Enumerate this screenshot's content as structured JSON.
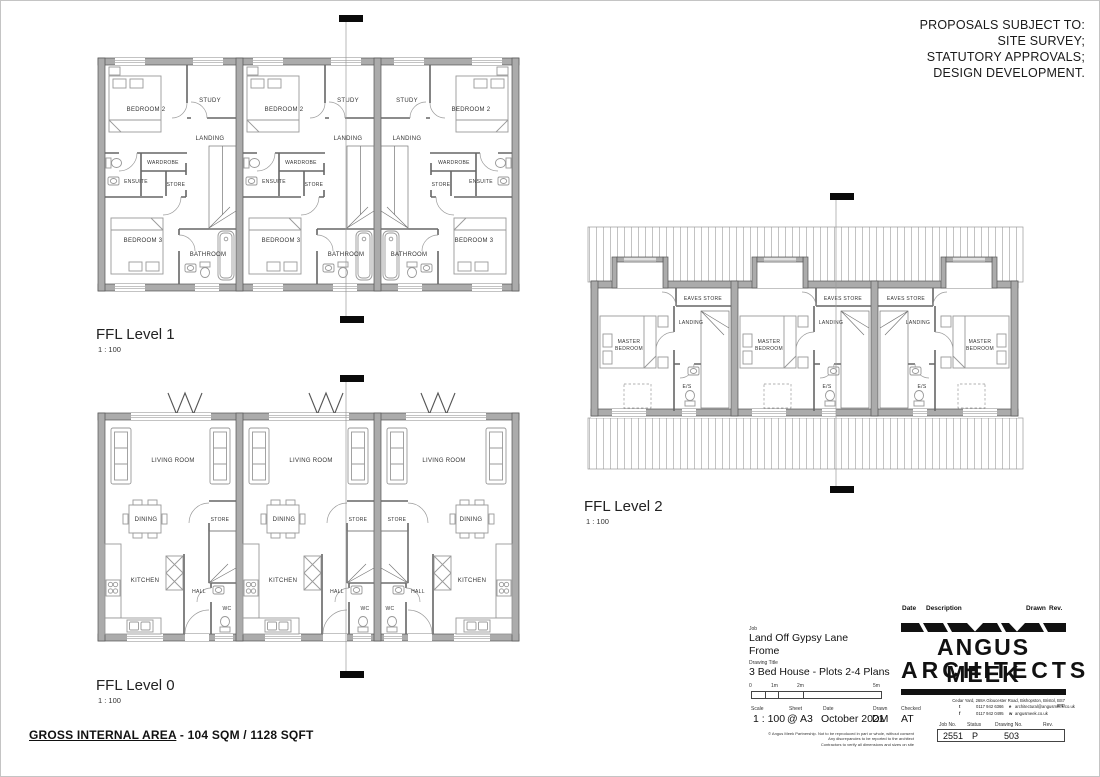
{
  "notice": {
    "lines": [
      "PROPOSALS SUBJECT TO:",
      "SITE SURVEY;",
      "STATUTORY APPROVALS;",
      "DESIGN DEVELOPMENT."
    ]
  },
  "plans": {
    "level1": {
      "title": "FFL Level 1",
      "scale": "1 : 100",
      "rooms": {
        "bedroom2": "BEDROOM 2",
        "study": "STUDY",
        "landing": "LANDING",
        "wardrobe": "WARDROBE",
        "ensuite": "ENSUITE",
        "store": "STORE",
        "bedroom3": "BEDROOM 3",
        "bathroom": "BATHROOM"
      }
    },
    "level0": {
      "title": "FFL Level 0",
      "scale": "1 : 100",
      "rooms": {
        "living": "LIVING ROOM",
        "dining": "DINING",
        "store": "STORE",
        "kitchen": "KITCHEN",
        "hall": "HALL",
        "wc": "WC"
      }
    },
    "level2": {
      "title": "FFL Level 2",
      "scale": "1 : 100",
      "rooms": {
        "eaves": "EAVES STORE",
        "landing": "LANDING",
        "master1": "MASTER",
        "master2": "BEDROOM",
        "es": "E/S"
      }
    }
  },
  "footer": {
    "label": "GROSS INTERNAL AREA",
    "sep": "-",
    "value": "104 SQM / 1128 SQFT"
  },
  "title_block": {
    "job_label": "Job",
    "job_name": "Land Off Gypsy Lane",
    "job_location": "Frome",
    "drawing_title_label": "Drawing Title",
    "drawing_title": "3 Bed House - Plots 2-4 Plans",
    "scalebar_ticks": [
      "0",
      "1m",
      "2m",
      "5m"
    ],
    "scale_label": "Scale",
    "scale": "1 : 100",
    "sheet_label": "Sheet",
    "sheet": "@ A3",
    "date_label": "Date",
    "date": "October 2021",
    "drawn_label": "Drawn",
    "drawn": "DM",
    "checked_label": "Checked",
    "checked": "AT",
    "rev_header": {
      "date": "Date",
      "description": "Description",
      "drawn": "Drawn",
      "rev": "Rev."
    },
    "firm": {
      "name1": "ANGUS MEEK",
      "name2": "ARCHITECTS",
      "address": "Cedar Yard, 268A Gloucester Road, Bishopston, Bristol, BS7 8PD",
      "t_label": "t",
      "tel": "0117 942 6366",
      "f_label": "f",
      "fax": "0117 942 0495",
      "e_label": "e",
      "email": "architectural@angusmeek.co.uk",
      "w_label": "w",
      "web": "angusmeek.co.uk"
    },
    "numbers": {
      "job_no_label": "Job No.",
      "job_no": "2551",
      "status_label": "Status",
      "status": "P",
      "drawing_no_label": "Drawing No.",
      "drawing_no": "503",
      "rev_label": "Rev."
    },
    "copyright": [
      "© Angus Meek Partnership. Not to be reproduced in part or whole, without consent",
      "Any discrepancies to be reported to the architect",
      "Contractors to verify all dimensions and sizes on site"
    ]
  },
  "colors": {
    "wall_gray": "#ababab",
    "ink": "#111111"
  }
}
